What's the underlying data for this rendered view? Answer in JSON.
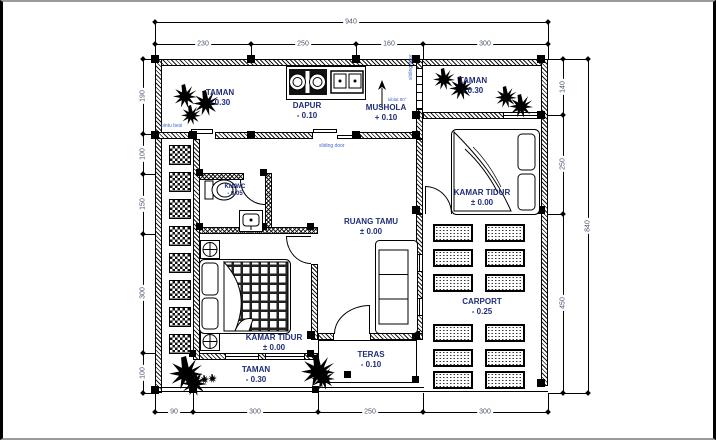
{
  "rooms": {
    "taman_tl": {
      "name": "TAMAN",
      "elev": "- 0.30"
    },
    "dapur": {
      "name": "DAPUR",
      "elev": "- 0.10"
    },
    "mushola": {
      "name": "MUSHOLA",
      "elev": "+ 0.10"
    },
    "taman_tr": {
      "name": "TAMAN",
      "elev": "- 0.30"
    },
    "kamar_tidur_kanan": {
      "name": "KAMAR TIDUR",
      "elev": "± 0.00"
    },
    "kmwc": {
      "name": "KM/WC",
      "elev": "- 0.05"
    },
    "ruang_tamu": {
      "name": "RUANG TAMU",
      "elev": "± 0.00"
    },
    "kamar_tidur_kiri": {
      "name": "KAMAR TIDUR",
      "elev": "± 0.00"
    },
    "carport": {
      "name": "CARPORT",
      "elev": "- 0.25"
    },
    "teras": {
      "name": "TERAS",
      "elev": "- 0.10"
    },
    "taman_bawah": {
      "name": "TAMAN",
      "elev": "- 0.30"
    }
  },
  "dimensions": {
    "top_overall": "940",
    "top": [
      "230",
      "250",
      "160",
      "300"
    ],
    "left": [
      "190",
      "100",
      "150",
      "300",
      "100"
    ],
    "right": [
      "140",
      "250",
      "450"
    ],
    "right_overall": "840",
    "bottom": [
      "90",
      "300",
      "250",
      "300"
    ]
  },
  "annotations": {
    "pintu_besi": "pintu besi",
    "sliding_door": "sliding door",
    "mushola_door": "sliding door",
    "kiblat": "kiblat 80°"
  },
  "colors": {
    "room_label": "#1f2d78",
    "dimension": "#4a5570",
    "annotation": "#4468cc",
    "drawing": "#000000",
    "background": "#ffffff"
  }
}
